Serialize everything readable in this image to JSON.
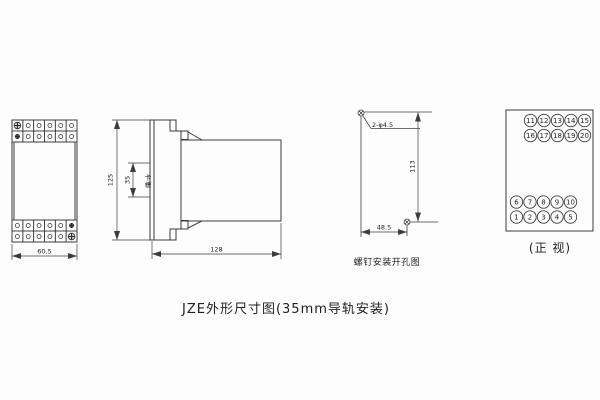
{
  "colors": {
    "background": "#fdfdfd",
    "line": "#3c3c3c",
    "text": "#1e1e1e"
  },
  "title": "JZE外形尺寸图(35mm导轨安装)",
  "front_view": {
    "width_dim": "60.5"
  },
  "side_view": {
    "height_dim": "125",
    "slot_dim": "35",
    "slot_label": "卡槽",
    "depth_dim": "128"
  },
  "drill_view": {
    "holes_label": "2-φ4.5",
    "height_dim": "113",
    "width_dim": "48.5",
    "caption": "螺钉安装开孔图"
  },
  "terminal_view": {
    "caption": "(正 视)",
    "top_row1": [
      "11",
      "12",
      "13",
      "14",
      "15"
    ],
    "top_row2": [
      "16",
      "17",
      "18",
      "19",
      "20"
    ],
    "bottom_row1": [
      "6",
      "7",
      "8",
      "9",
      "10"
    ],
    "bottom_row2": [
      "1",
      "2",
      "3",
      "4",
      "5"
    ]
  }
}
